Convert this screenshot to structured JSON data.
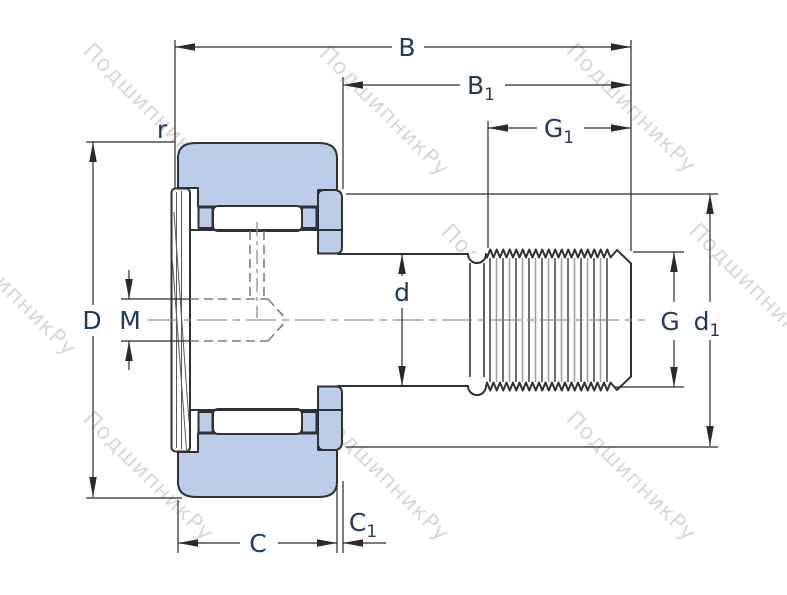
{
  "figure": {
    "type": "technical drawing",
    "subject": "stud-type cam follower bearing cross-section with dimension callouts",
    "watermark_text": "ПодшипникРу"
  },
  "labels": {
    "B": {
      "base": "B",
      "sub": ""
    },
    "B1": {
      "base": "B",
      "sub": "1"
    },
    "G1": {
      "base": "G",
      "sub": "1"
    },
    "r": {
      "base": "r",
      "sub": ""
    },
    "D": {
      "base": "D",
      "sub": ""
    },
    "M": {
      "base": "M",
      "sub": ""
    },
    "d": {
      "base": "d",
      "sub": ""
    },
    "G": {
      "base": "G",
      "sub": ""
    },
    "d1": {
      "base": "d",
      "sub": "1"
    },
    "C": {
      "base": "C",
      "sub": ""
    },
    "C1": {
      "base": "C",
      "sub": "1"
    }
  },
  "colors": {
    "part_fill": "#bccde8",
    "outline": "#2e3138",
    "dimension_lines": "#2a2a2a",
    "label_text": "#1d3a5c",
    "centerline": "#909090",
    "hidden_lines": "#7d7d7d",
    "watermark": "#9a9a9a",
    "background": "#ffffff"
  }
}
